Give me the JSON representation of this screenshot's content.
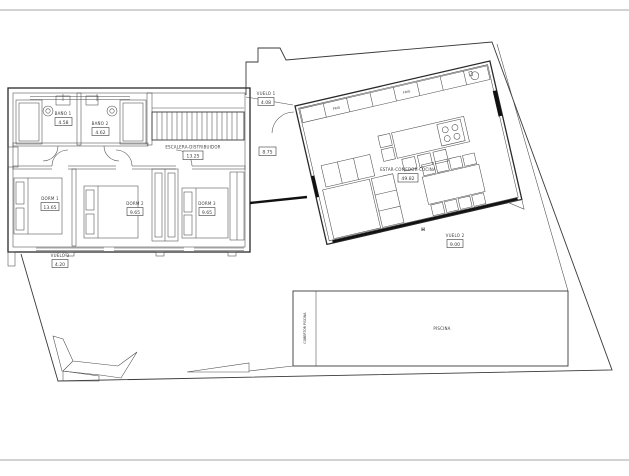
{
  "rooms": {
    "bano1": {
      "name": "BAÑO 1",
      "area": "4.58"
    },
    "bano2": {
      "name": "BAÑO 2",
      "area": "4.62"
    },
    "escalera": {
      "name": "ESCALERA-DISTRIBUIDOR",
      "area": "13.25"
    },
    "dorm1": {
      "name": "DORM 1",
      "area": "13.65"
    },
    "dorm2": {
      "name": "DORM 2",
      "area": "9.65"
    },
    "dorm3": {
      "name": "DORM 3",
      "area": "9.65"
    },
    "estar": {
      "name": "ESTAR-COMEDOR-COCINA",
      "area": "49.82"
    },
    "vuelo1": {
      "name": "VUELO 1",
      "area": "4.08"
    },
    "vuelo2": {
      "name": "VUELO 2",
      "area": "9.00"
    },
    "vuelo3": {
      "name": "VUELO 3",
      "area": "4.20"
    }
  },
  "annotations": {
    "area_porch": "8.75",
    "h_marker": "H"
  },
  "appliances": {
    "fridge1": "FRIG",
    "fridge2": "FRIG"
  },
  "pool": {
    "name": "PISCINA",
    "cover": "COBERTOR PISCINA"
  },
  "colors": {
    "line": "#3a3a3a",
    "wall": "#111111",
    "background": "#ffffff"
  }
}
